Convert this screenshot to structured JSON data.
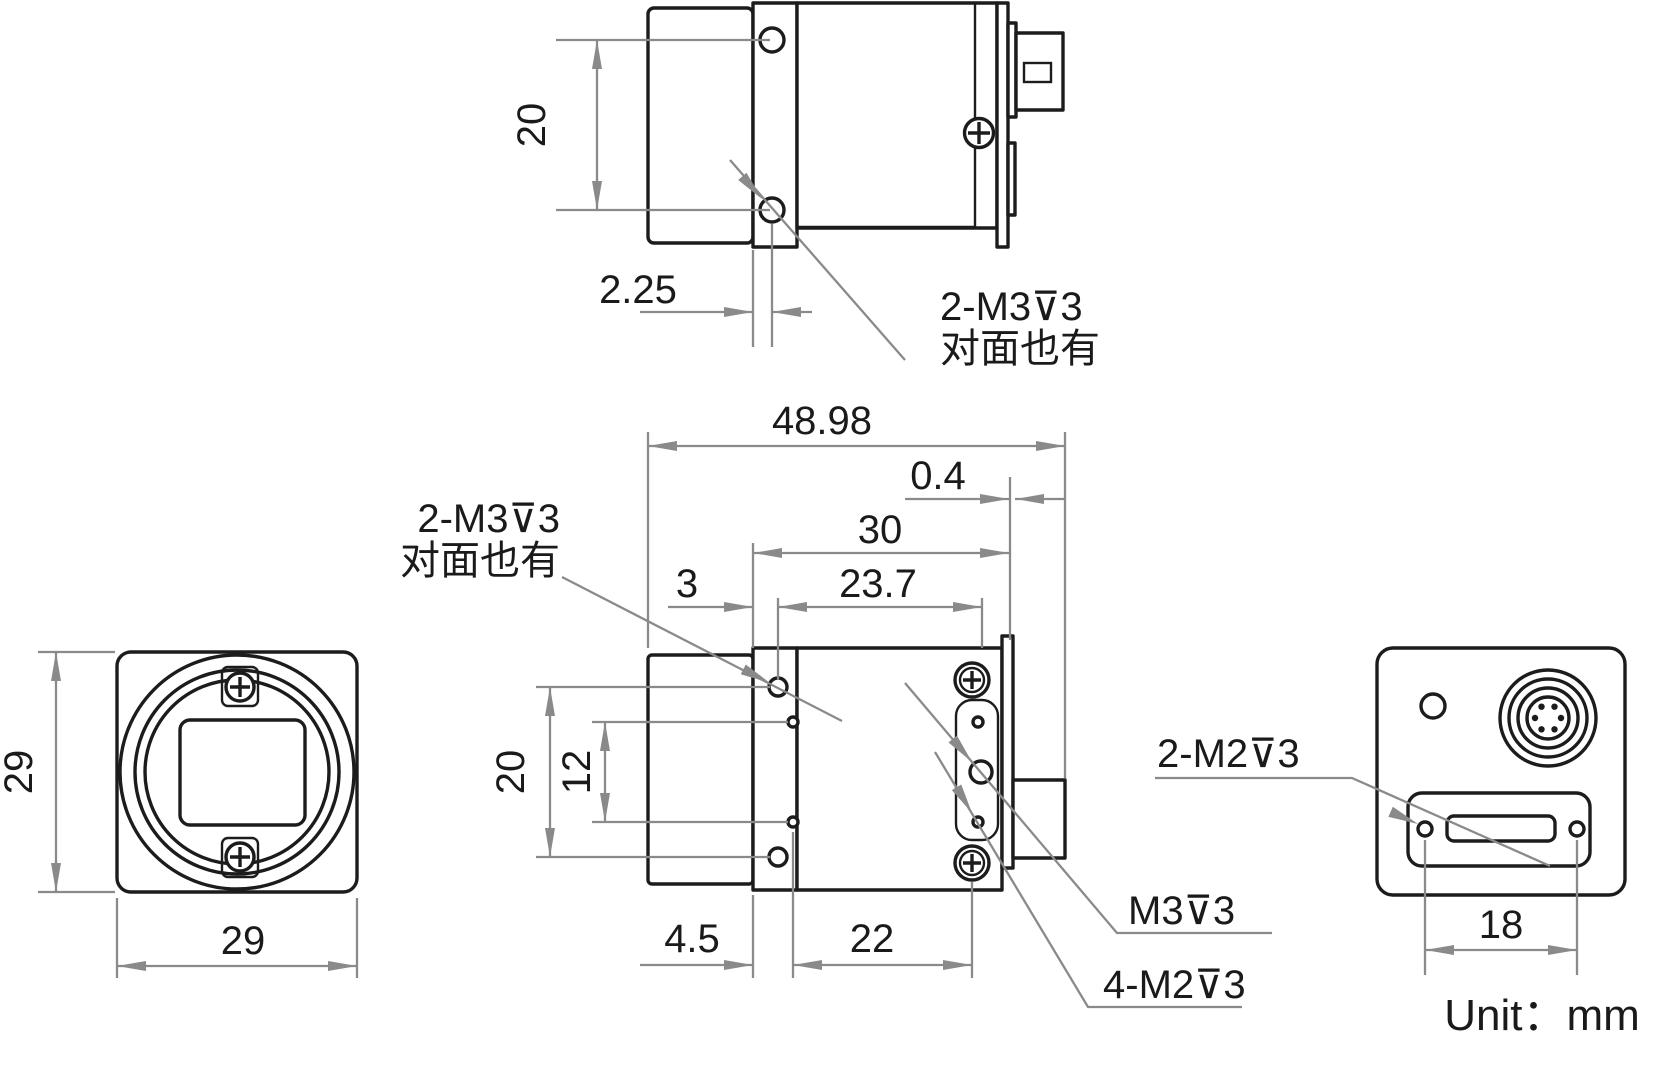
{
  "unit_label": "Unit：mm",
  "colors": {
    "object_line": "#1c1c1c",
    "dim_line": "#8a8a8a",
    "text": "#1a1a1a"
  },
  "notes": {
    "top_thread_note_line1": "2-M3⊽3",
    "top_thread_note_line2": "对面也有",
    "side_thread_note_line1": "2-M3⊽3",
    "side_thread_note_line2": "对面也有",
    "m3_label": "M3⊽3",
    "m2x4_label": "4-M2⊽3",
    "m2x2_label": "2-M2⊽3"
  },
  "dims": {
    "top_hole_spacing": "20",
    "top_hole_offset": "2.25",
    "front_height": "29",
    "front_width": "29",
    "side_total_length": "48.98",
    "side_plate_offset": "0.4",
    "side_span_30": "30",
    "side_offset_3": "3",
    "side_span_23_7": "23.7",
    "side_hole_spacing": "20",
    "side_inner_spacing": "12",
    "side_offset_4_5": "4.5",
    "side_span_22": "22",
    "back_connector_span": "18"
  }
}
